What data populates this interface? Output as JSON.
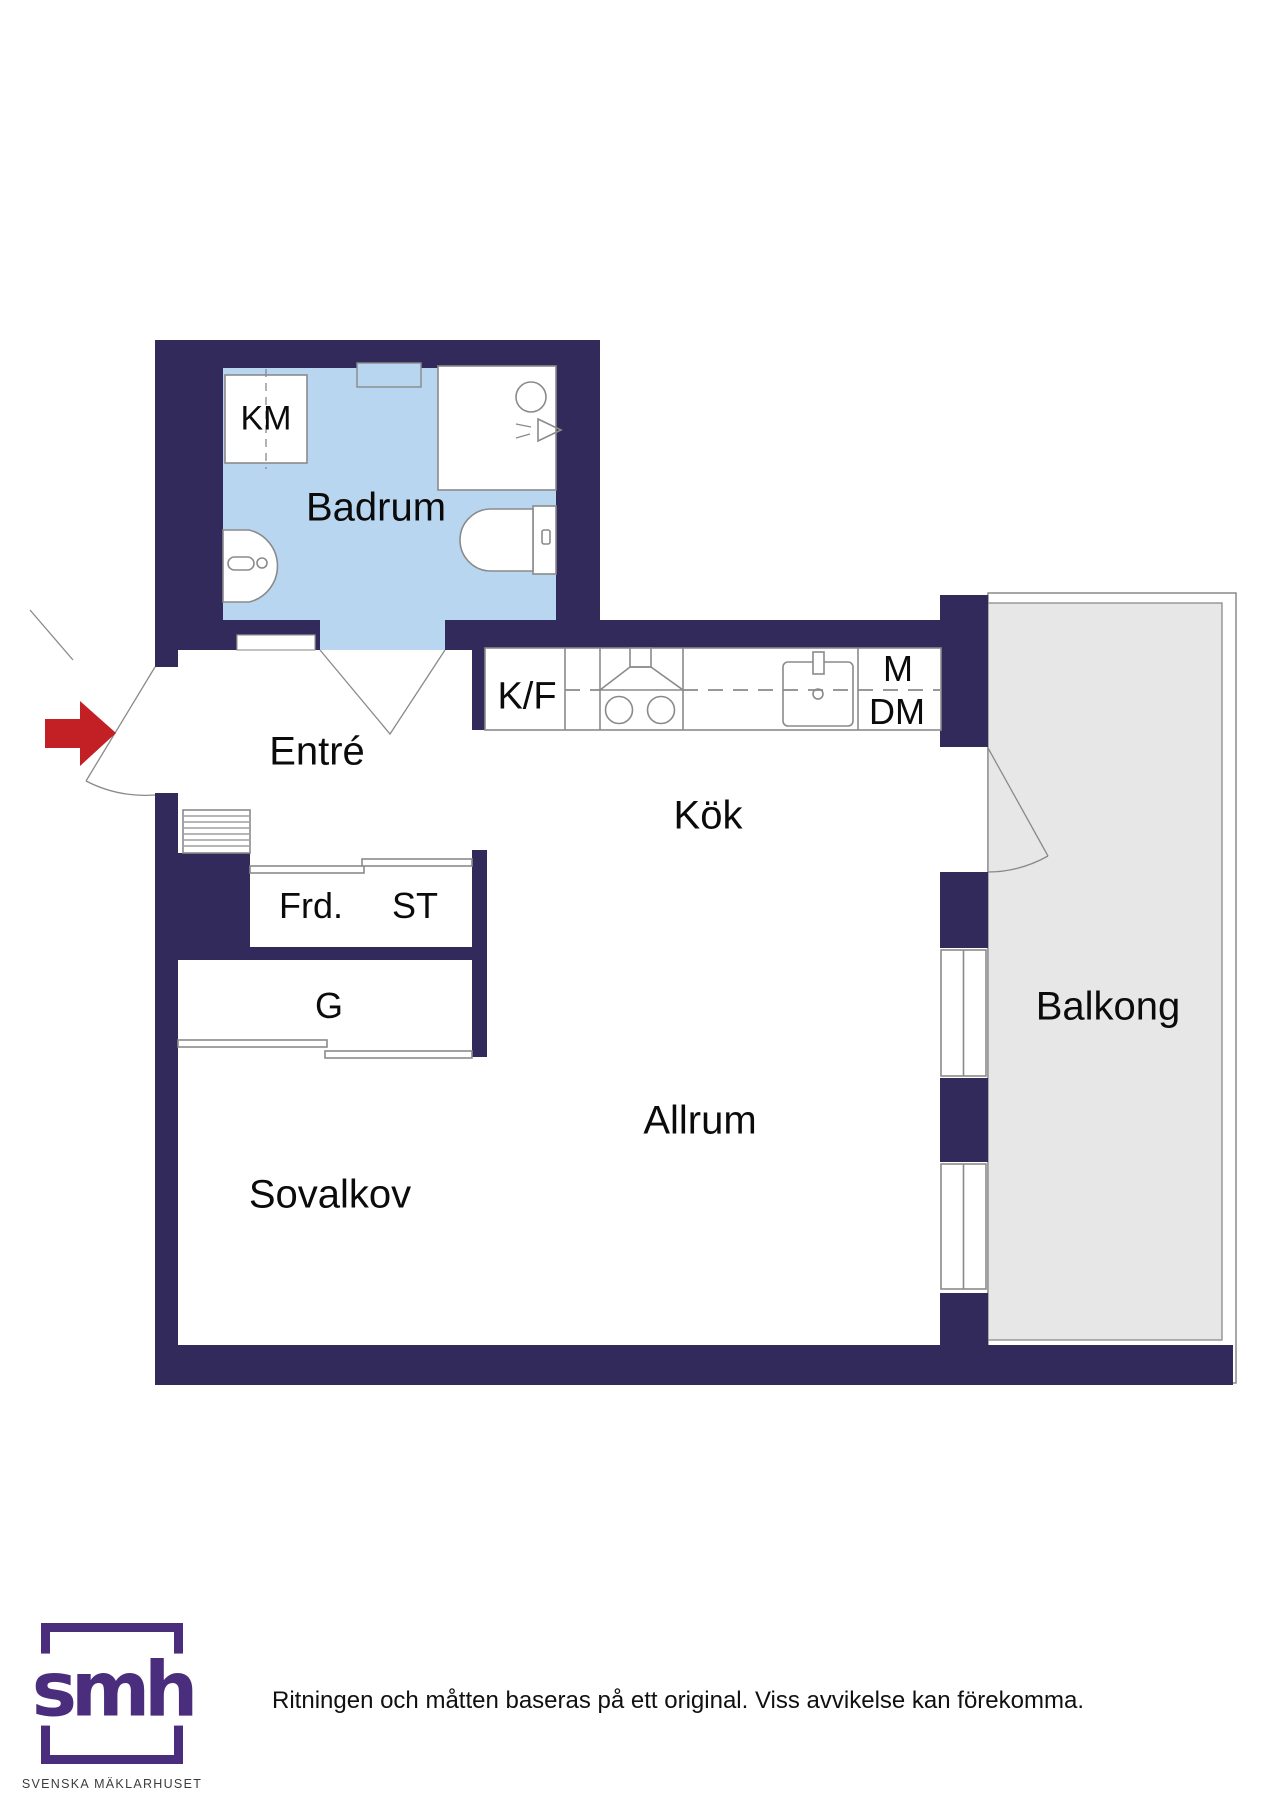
{
  "floorplan": {
    "rooms": {
      "badrum": "Badrum",
      "entre": "Entré",
      "kok": "Kök",
      "allrum": "Allrum",
      "sovalkov": "Sovalkov",
      "balkong": "Balkong"
    },
    "fixtures": {
      "km": "KM",
      "kf": "K/F",
      "m": "M",
      "dm": "DM",
      "frd": "Frd.",
      "st": "ST",
      "g": "G"
    },
    "colors": {
      "wall": "#322A5A",
      "bathroom_floor": "#B9D6F1",
      "balcony_floor": "#E7E7E7",
      "line_gray": "#8A8A8A",
      "arrow_red": "#C32026",
      "logo_purple": "#4B2D7D"
    }
  },
  "footer": {
    "logo_text": "smh",
    "logo_subtext": "SVENSKA MÄKLARHUSET",
    "disclaimer": "Ritningen och måtten baseras på ett original. Viss avvikelse kan förekomma."
  }
}
